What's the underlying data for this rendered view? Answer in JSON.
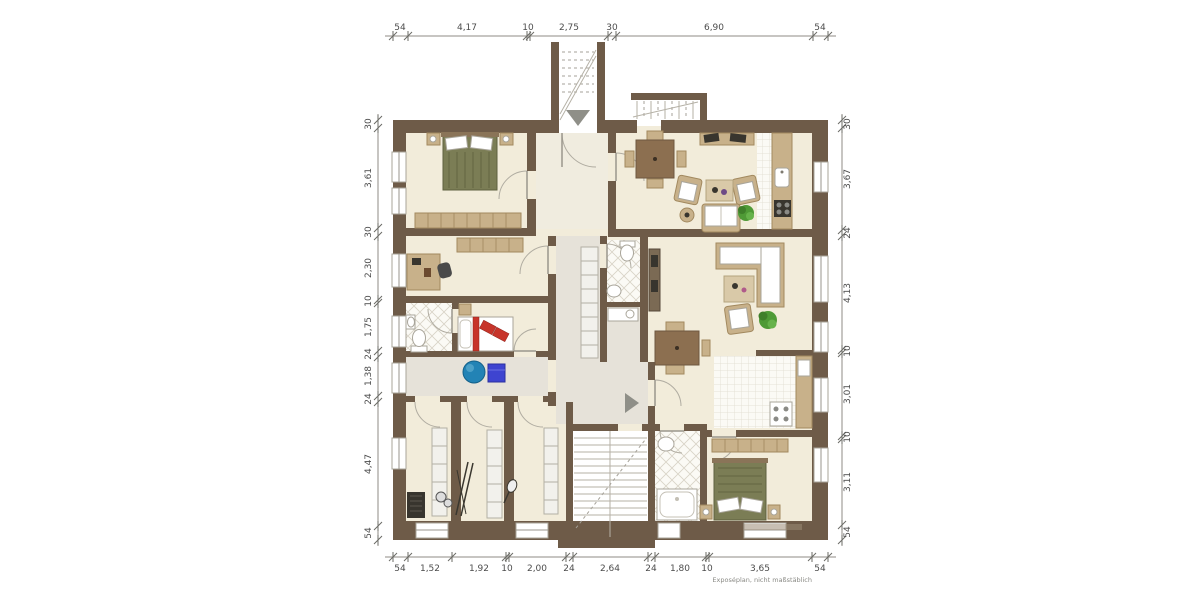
{
  "dimensions": {
    "top": [
      "54",
      "4,17",
      "10",
      "2,75",
      "30",
      "6,90",
      "54"
    ],
    "bottom": [
      "54",
      "1,52",
      "1,92",
      "10",
      "2,00",
      "24",
      "2,64",
      "24",
      "1,80",
      "10",
      "3,65",
      "54"
    ],
    "left": [
      "30",
      "3,61",
      "30",
      "2,30",
      "10",
      "1,75",
      "24",
      "1,38",
      "24",
      "4,47",
      "54"
    ],
    "right": [
      "30",
      "3,67",
      "24",
      "4,13",
      "10",
      "3,01",
      "10",
      "3,11",
      "54"
    ]
  },
  "footnote": "Exposéplan, nicht maßstäblich",
  "colors": {
    "wall": "#6e5b48",
    "floor": "#f2ecda",
    "hall": "#e6e2d9",
    "hall_light": "#f0ecdf",
    "tile": "#fbfaf5",
    "tile_line": "#d8d3c6",
    "tan": "#c8b18a",
    "tan_dark": "#a2895f",
    "wood": "#8c6f50",
    "bed_green": "#7b7d55",
    "red": "#c7342a",
    "ball_blue": "#2383b5",
    "cube_blue": "#3e44d0",
    "plant": "#4f9a36",
    "dark": "#38352e"
  }
}
